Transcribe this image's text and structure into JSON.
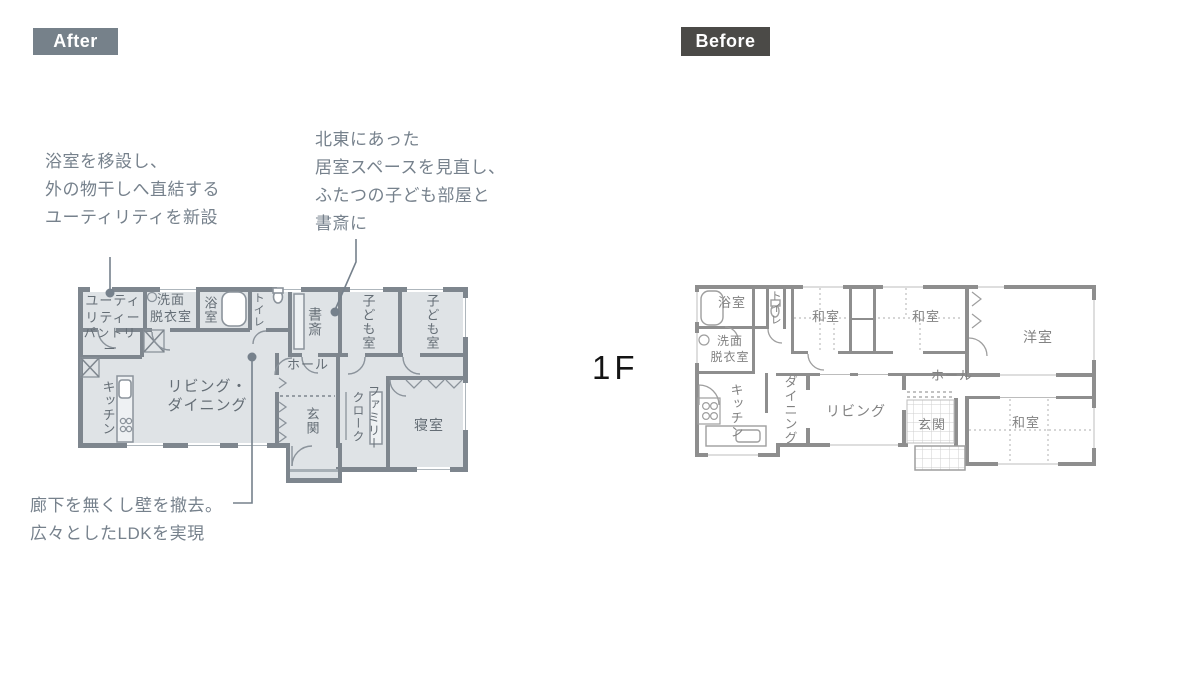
{
  "floor_label": "1F",
  "after": {
    "badge_label": "After",
    "rooms": {
      "utility": "ユーティ\nリティー",
      "washroom": "洗面\n脱衣室",
      "bathroom": "浴室",
      "toilet": "トイレ",
      "pantry": "パントリー",
      "kitchen": "キッチン",
      "living_dining": "リビング・\nダイニング",
      "study": "書斎",
      "kids_room_1": "子ども室",
      "kids_room_2": "子ども室",
      "hall": "ホール",
      "entrance": "玄関",
      "family_closet": "ファミリー\nクローク",
      "bedroom": "寝室"
    }
  },
  "before": {
    "badge_label": "Before",
    "rooms": {
      "bathroom": "浴室",
      "toilet": "トイレ",
      "washroom": "洗面\n脱衣室",
      "japanese_room_1": "和室",
      "japanese_room_2": "和室",
      "western_room": "洋室",
      "kitchen": "キッチン",
      "dining": "ダイニング",
      "living": "リビング",
      "hall": "ホール",
      "entrance": "玄関",
      "japanese_room_3": "和室"
    }
  },
  "annotations": {
    "utility_note": "浴室を移設し、\n外の物干しへ直結する\nユーティリティを新設",
    "kids_note": "北東にあった\n居室スペースを見直し、\nふたつの子ども部屋と\n書斎に",
    "ldk_note": "廊下を無くし壁を撤去。\n広々としたLDKを実現"
  },
  "colors": {
    "accent": "#76818c",
    "after_badge_bg": "#76818a",
    "before_badge_bg": "#4b4a47",
    "after_wall": "#7e868e",
    "after_floor": "#dfe3e6",
    "before_wall": "#8e8e8e",
    "floor_label_color": "#141414"
  }
}
